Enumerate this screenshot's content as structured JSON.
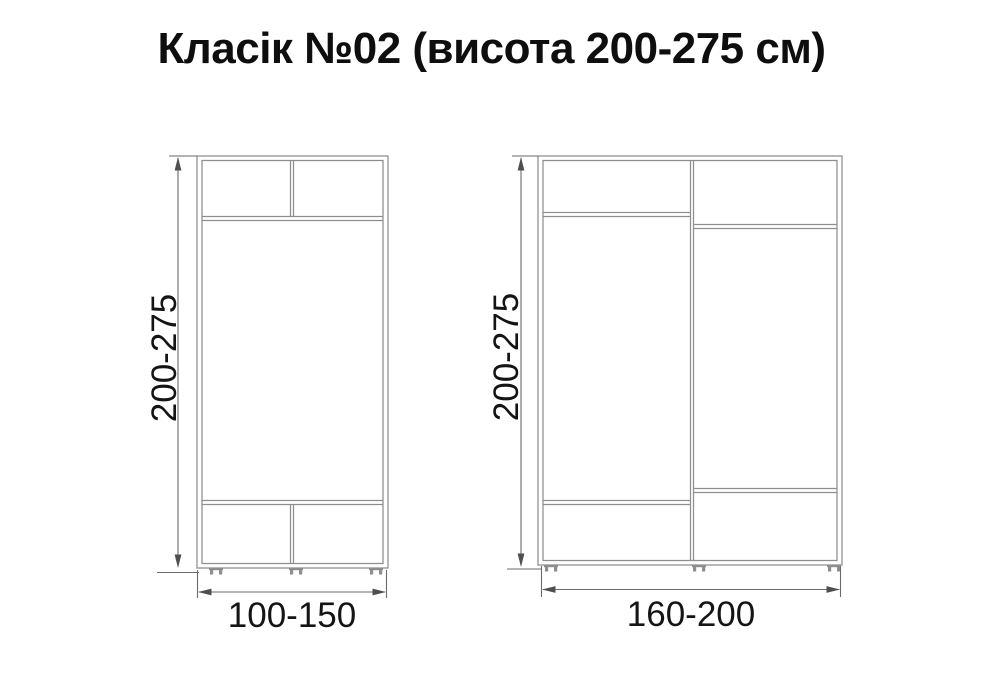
{
  "title": {
    "main": "Класік №02",
    "sub": "(висота 200-275 см)"
  },
  "wardrobes": {
    "left": {
      "height_label": "200-275",
      "width_label": "100-150"
    },
    "right": {
      "height_label": "200-275",
      "width_label": "160-200"
    }
  },
  "colors": {
    "furniture_line": "#8e8e8e",
    "dimension_line": "#6a6a6a",
    "arrow": "#4f4f4f",
    "text": "#141414",
    "background": "#ffffff"
  }
}
